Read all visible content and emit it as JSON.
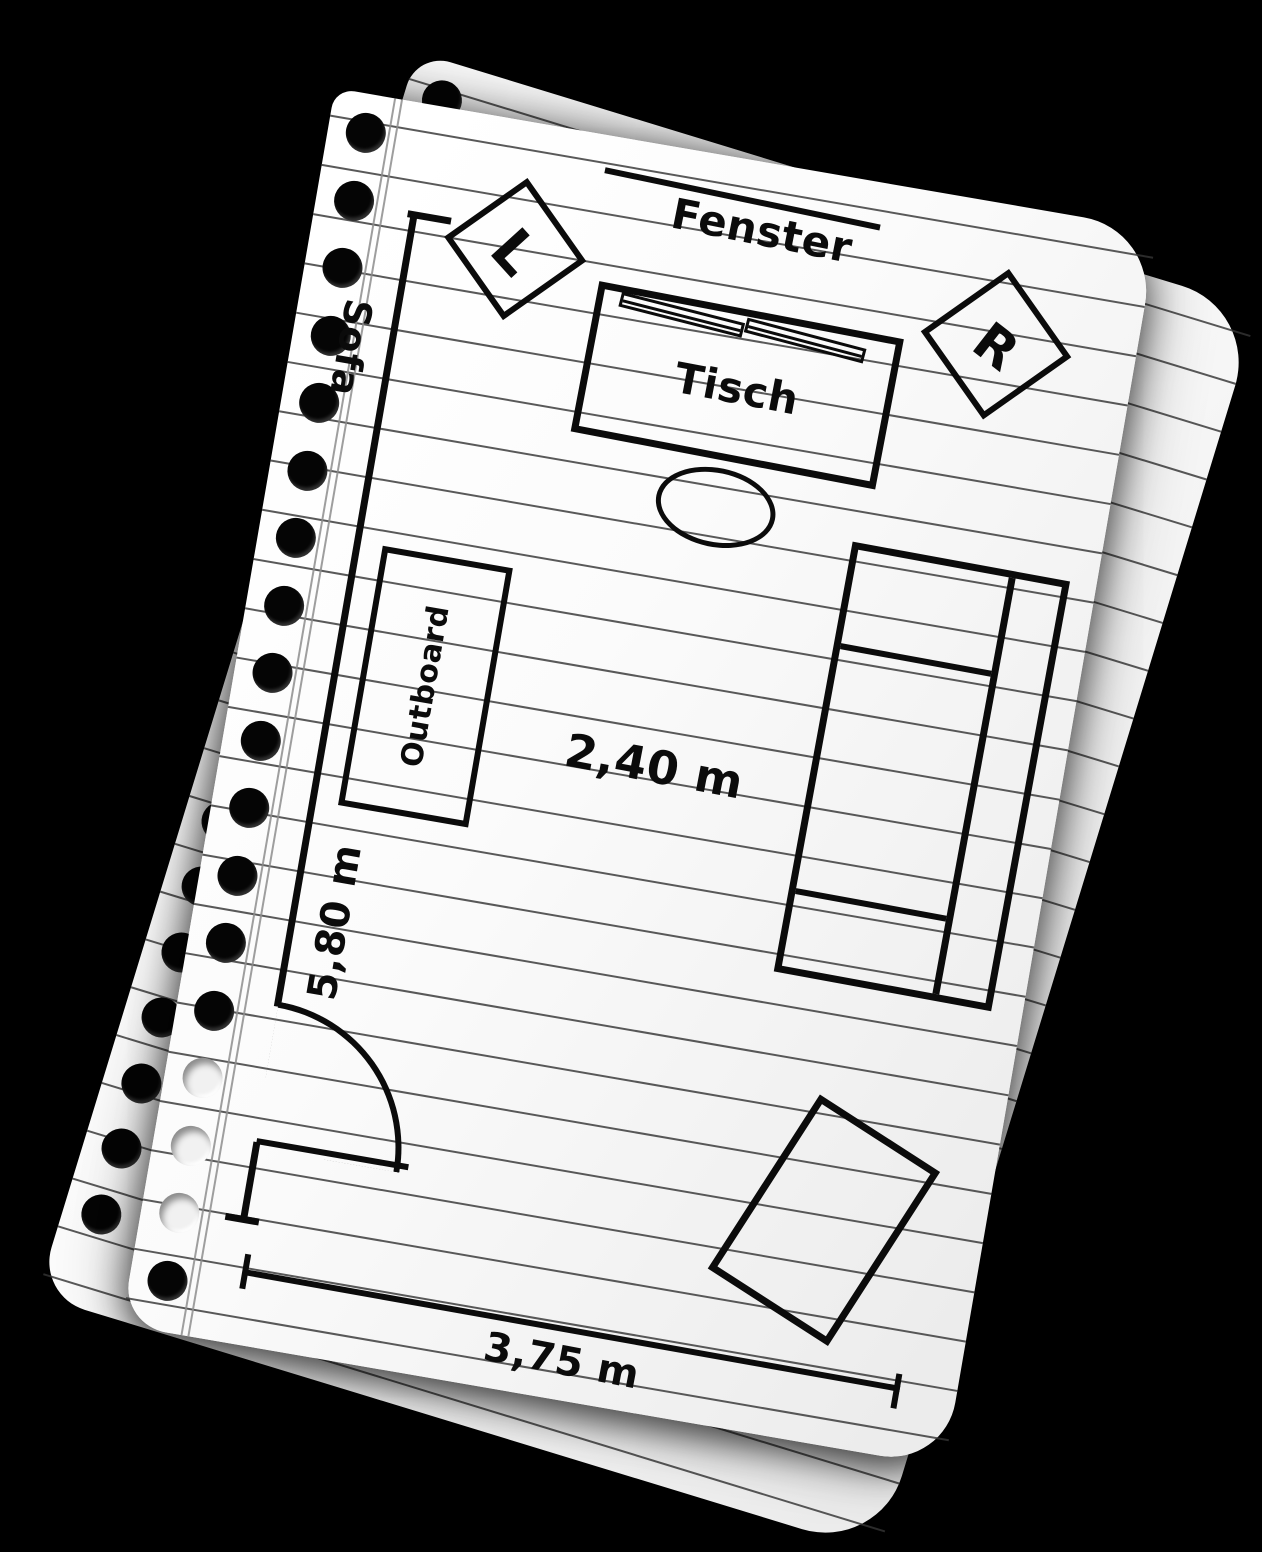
{
  "scene": {
    "background_color": "#000000",
    "paper_color": "#ffffff",
    "ink_color": "#0b0b0b",
    "ruled_line_color": "#343434",
    "margin_line_color": "#8d8d8d"
  },
  "plan": {
    "window_label": "Fenster",
    "speaker_left_label": "L",
    "speaker_right_label": "R",
    "desk_label": "Tisch",
    "rack_label": "Outboard",
    "sofa_label": "Sofa",
    "dim_center": "2,40 m",
    "dim_left": "5,80 m",
    "dim_bottom": "3,75 m"
  }
}
